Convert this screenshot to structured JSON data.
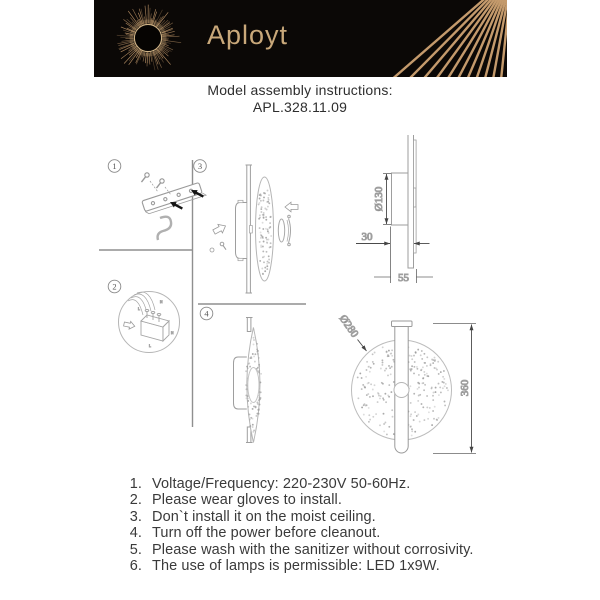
{
  "header": {
    "brand": "Aployt",
    "title": "Model assembly instructions:",
    "model": "APL.328.11.09",
    "colors": {
      "bar_bg": "#0b0806",
      "gold": "#c49a6c",
      "gold_bright": "#e2c392"
    }
  },
  "diagram": {
    "steps": [
      {
        "number": "1"
      },
      {
        "number": "2"
      },
      {
        "number": "3"
      },
      {
        "number": "4"
      }
    ],
    "labels": {
      "dia130": "Ø130",
      "depth30": "30",
      "depth55": "55",
      "dia280": "Ø280",
      "height360": "360"
    },
    "wiring_labels": {
      "top_n": "N",
      "top_l": "L",
      "bottom_n": "N",
      "bottom_l": "L"
    },
    "line_gray": "#9e9e9e",
    "dim_gray": "#4a4a4a"
  },
  "instructions": {
    "items": [
      {
        "num": "1.",
        "text": "Voltage/Frequency: 220-230V 50-60Hz."
      },
      {
        "num": "2.",
        "text": "Please wear gloves to install."
      },
      {
        "num": "3.",
        "text": "Don`t install it on the moist ceiling."
      },
      {
        "num": "4.",
        "text": "Turn off the power before cleanout."
      },
      {
        "num": "5.",
        "text": "Please wash with the sanitizer without corrosivity."
      },
      {
        "num": "6.",
        "text": "The use of lamps is permissible: LED 1x9W."
      }
    ]
  }
}
